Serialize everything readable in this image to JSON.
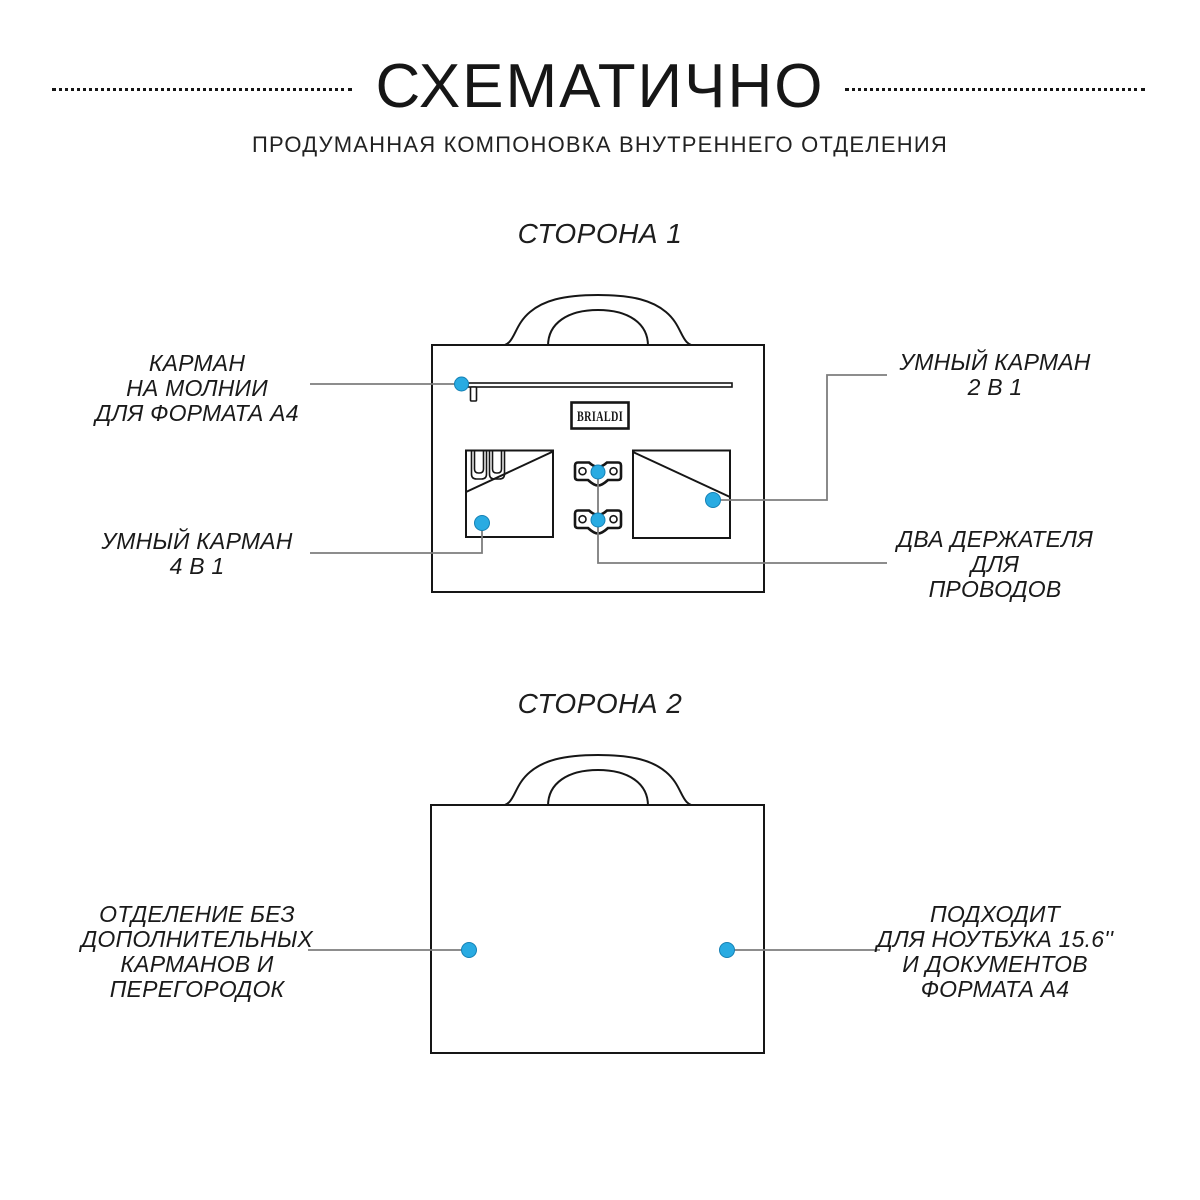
{
  "page": {
    "title": "СХЕМАТИЧНО",
    "subtitle": "ПРОДУМАННАЯ КОМПОНОВКА ВНУТРЕННЕГО ОТДЕЛЕНИЯ"
  },
  "brand": {
    "logo": "BRIALDI"
  },
  "colors": {
    "accent_blue": "#29abe2",
    "line_black": "#161616",
    "connector_gray": "#7d7d7d"
  },
  "side1": {
    "heading": "СТОРОНА 1",
    "callouts": {
      "zip_pocket": {
        "lines": [
          "КАРМАН",
          "НА МОЛНИИ",
          "ДЛЯ ФОРМАТА А4"
        ]
      },
      "smart_2in1": {
        "lines": [
          "УМНЫЙ КАРМАН",
          "2 В 1"
        ]
      },
      "smart_4in1": {
        "lines": [
          "УМНЫЙ КАРМАН",
          "4 В 1"
        ]
      },
      "cable_holders": {
        "lines": [
          "ДВА ДЕРЖАТЕЛЯ",
          "ДЛЯ",
          "ПРОВОДОВ"
        ]
      }
    }
  },
  "side2": {
    "heading": "СТОРОНА 2",
    "callouts": {
      "empty_compartment": {
        "lines": [
          "ОТДЕЛЕНИЕ БЕЗ",
          "ДОПОЛНИТЕЛЬНЫХ",
          "КАРМАНОВ И",
          "ПЕРЕГОРОДОК"
        ]
      },
      "laptop_fit": {
        "lines": [
          "ПОДХОДИТ",
          "ДЛЯ НОУТБУКА 15.6''",
          "И ДОКУМЕНТОВ",
          "ФОРМАТА А4"
        ]
      }
    }
  }
}
